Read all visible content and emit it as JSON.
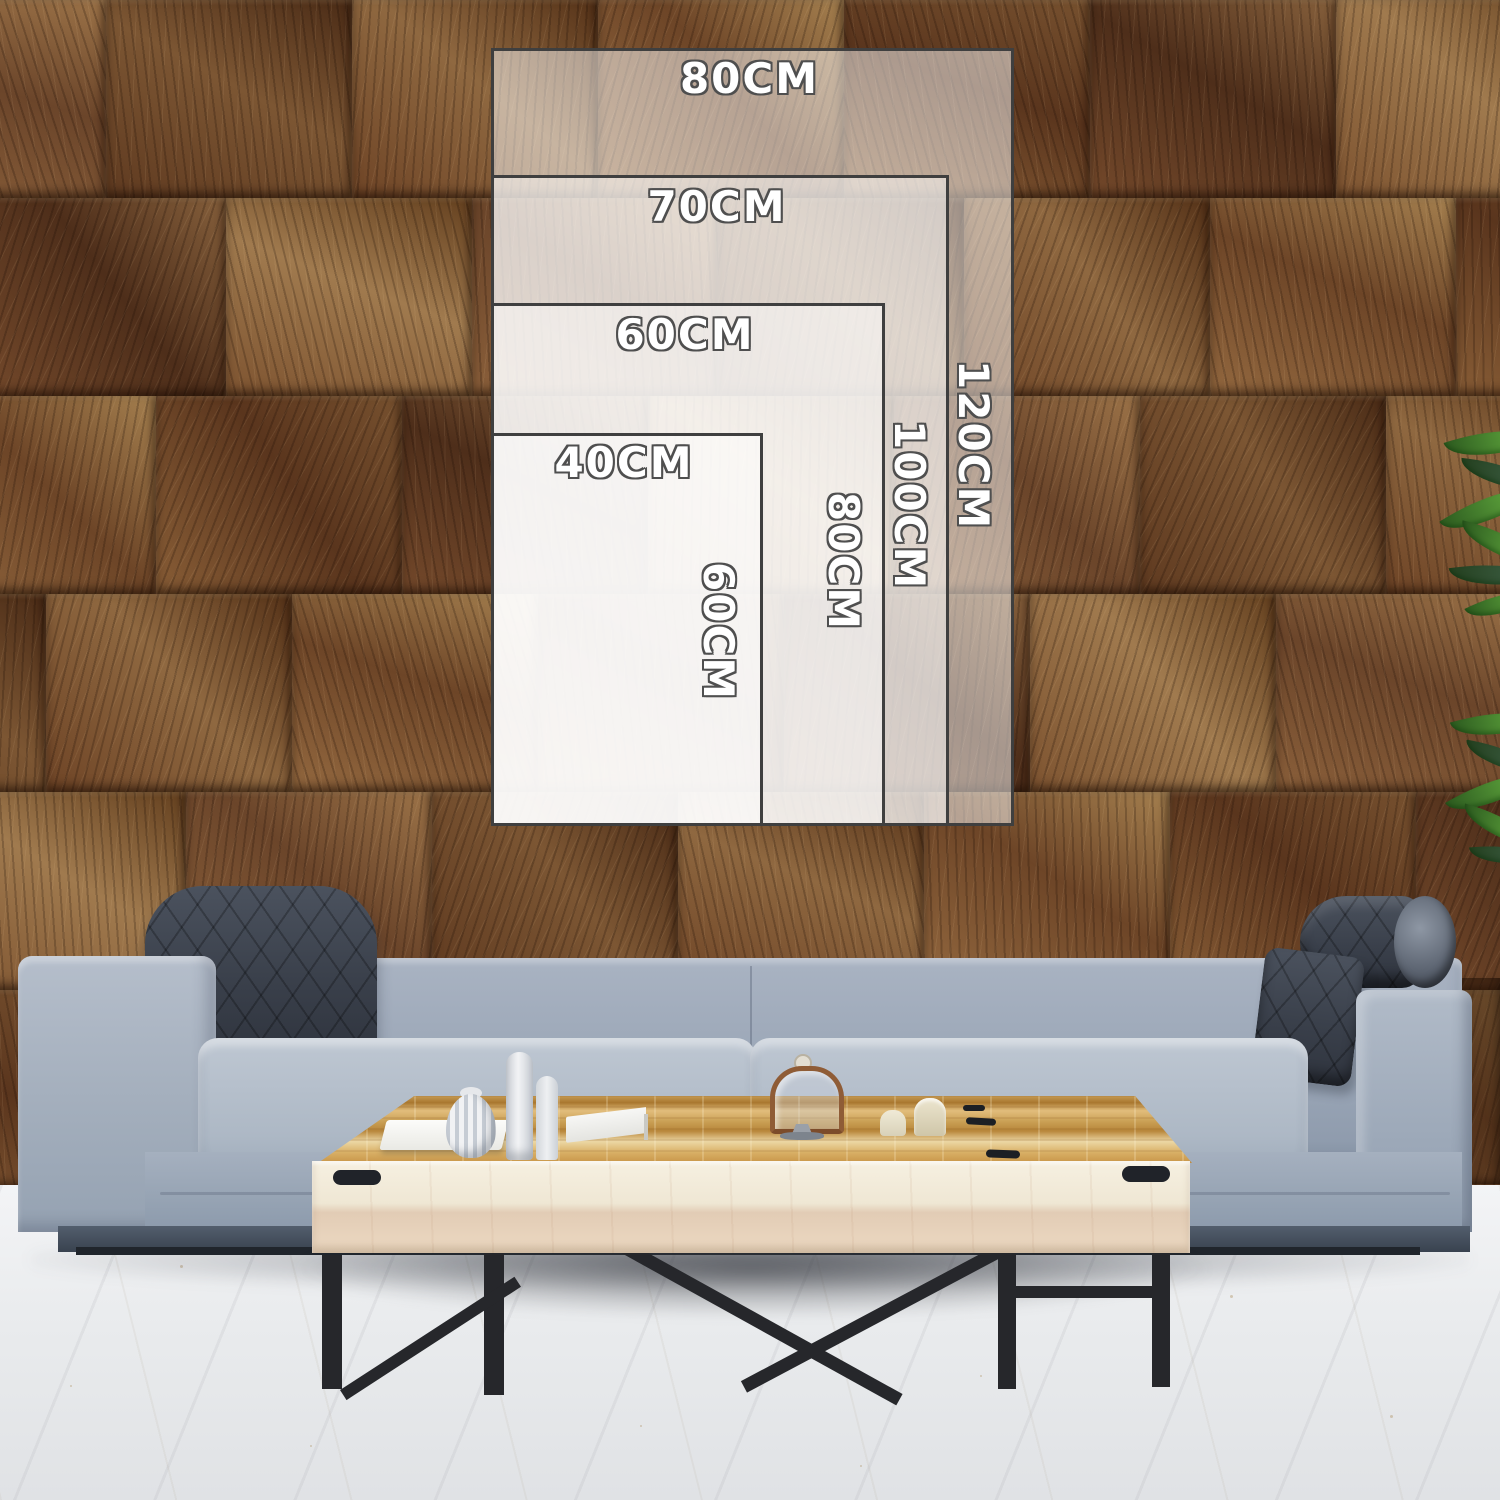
{
  "size_guide": {
    "title": "canvas size comparison overlay",
    "border_color": "#3f3f3f",
    "fill_color": "rgba(255,255,255,0.5)",
    "label_color": "#ffffff",
    "label_outline_color": "#4f4f4f",
    "sizes": [
      {
        "id": "80x120",
        "width_label": "80CM",
        "height_label": "120CM"
      },
      {
        "id": "70x100",
        "width_label": "70CM",
        "height_label": "100CM"
      },
      {
        "id": "60x80",
        "width_label": "60CM",
        "height_label": "80CM"
      },
      {
        "id": "40x60",
        "width_label": "40CM",
        "height_label": "60CM"
      }
    ]
  },
  "scene": {
    "description_colors": {
      "wall_wood_brown": "#7b5233",
      "wall_wood_dark": "#4b2e1a",
      "sofa_fabric_gray": "#a9b3c2",
      "headrest_charcoal": "#3f4550",
      "table_wood_gold": "#d9b066",
      "table_front_cream": "#efe7d4",
      "floor_white": "#eef0f2",
      "plant_green": "#579a38",
      "leg_black": "#26272b"
    }
  }
}
